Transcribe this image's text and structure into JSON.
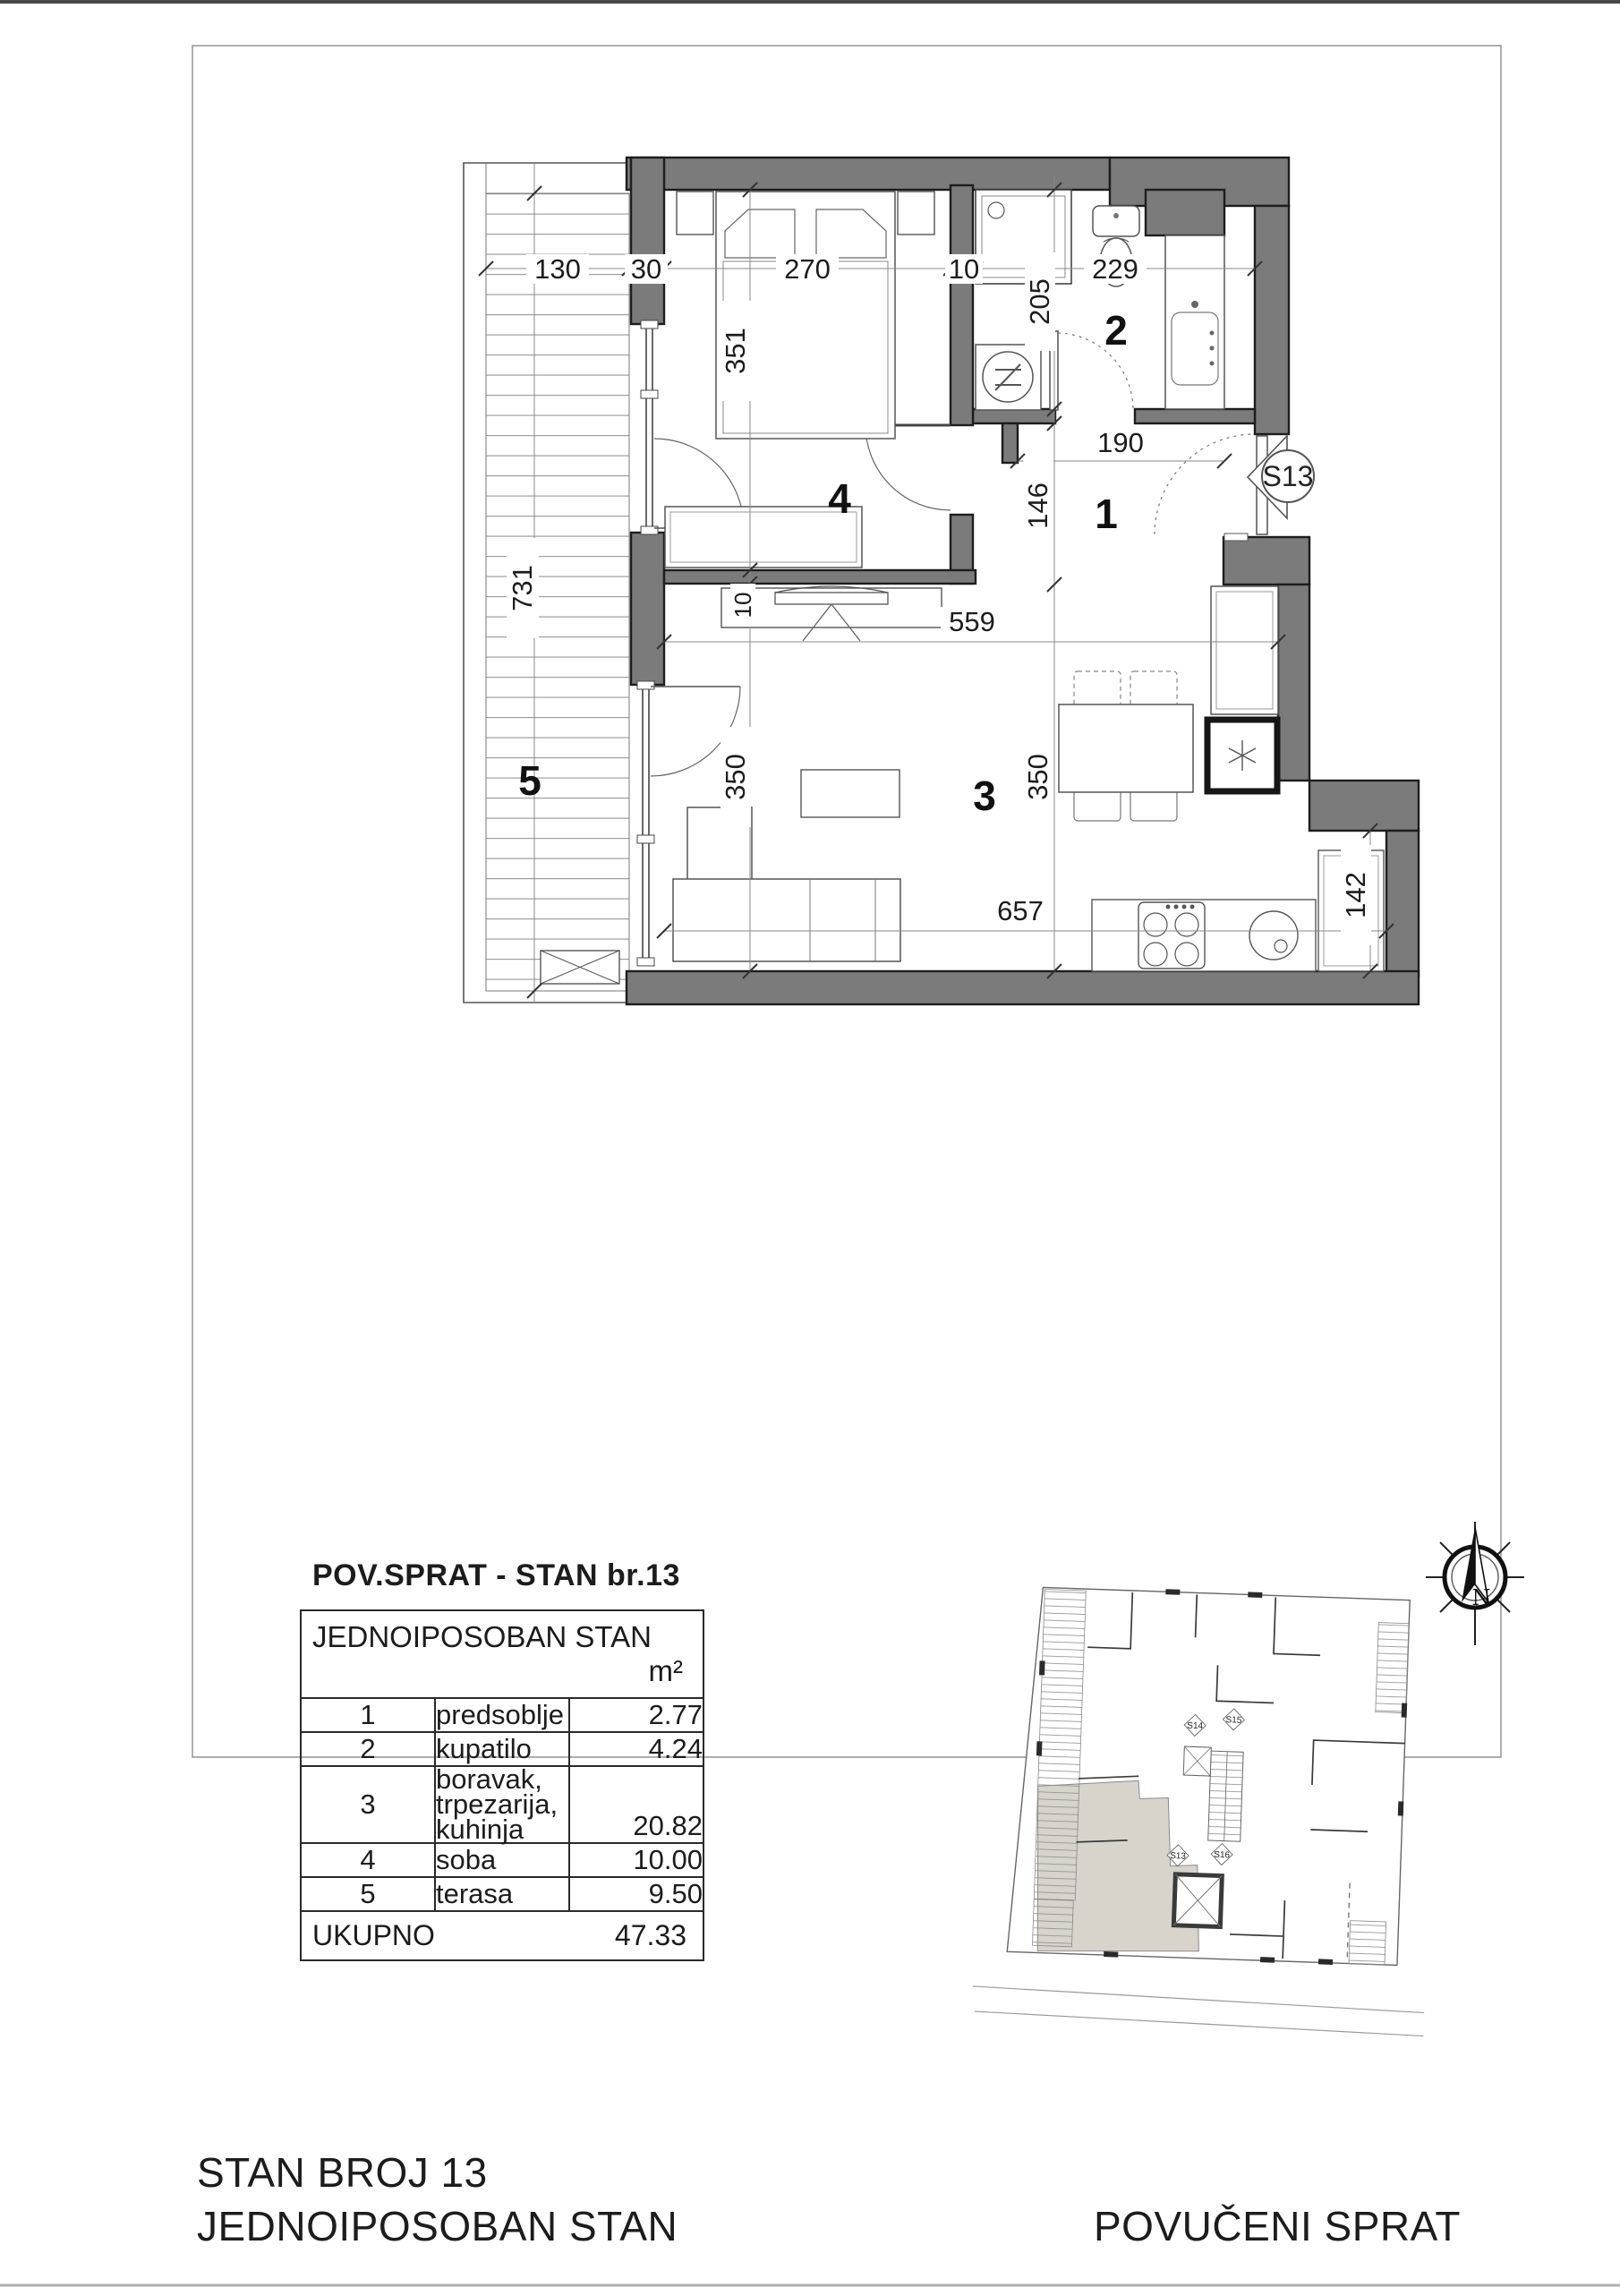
{
  "table": {
    "title": "POV.SPRAT - STAN br.13",
    "header": {
      "name": "JEDNOIPOSOBAN STAN",
      "unit": "m²"
    },
    "rows": [
      {
        "num": "1",
        "name": "predsoblje",
        "area": "2.77"
      },
      {
        "num": "2",
        "name": "kupatilo",
        "area": "4.24"
      },
      {
        "num": "3",
        "name": "boravak, trpezarija,\nkuhinja",
        "area": "20.82"
      },
      {
        "num": "4",
        "name": "soba",
        "area": "10.00"
      },
      {
        "num": "5",
        "name": "terasa",
        "area": "9.50"
      }
    ],
    "total": {
      "label": "UKUPNO",
      "area": "47.33"
    }
  },
  "footer": {
    "line1": "STAN BROJ 13",
    "line2": "JEDNOIPOSOBAN STAN",
    "right": "POVUČENI SPRAT"
  },
  "plan": {
    "unit_marker": "S13",
    "rooms": {
      "hall": "1",
      "bath": "2",
      "living": "3",
      "bedroom": "4",
      "terrace": "5"
    },
    "dims": {
      "terrace_width": "130",
      "wall_top": "30",
      "bedroom_width": "270",
      "wall_mid": "10",
      "bath_width": "229",
      "bath_depth": "205",
      "bedroom_depth": "351",
      "terrace_length": "731",
      "hall_width": "190",
      "hall_depth": "146",
      "living_width": "559",
      "living_depth_left": "350",
      "living_depth_right": "350",
      "kitchen_width": "657",
      "fridge_niche": "142",
      "wall_inner": "10"
    }
  },
  "keyplan": {
    "markers": {
      "s13": "S13",
      "s14": "S14",
      "s15": "S15",
      "s16": "S16"
    }
  },
  "compass": {
    "north": "N"
  },
  "colors": {
    "wall_fill": "#7b7b7b",
    "line_dark": "#1d1d1d",
    "highlight": "#d8d4cb"
  }
}
